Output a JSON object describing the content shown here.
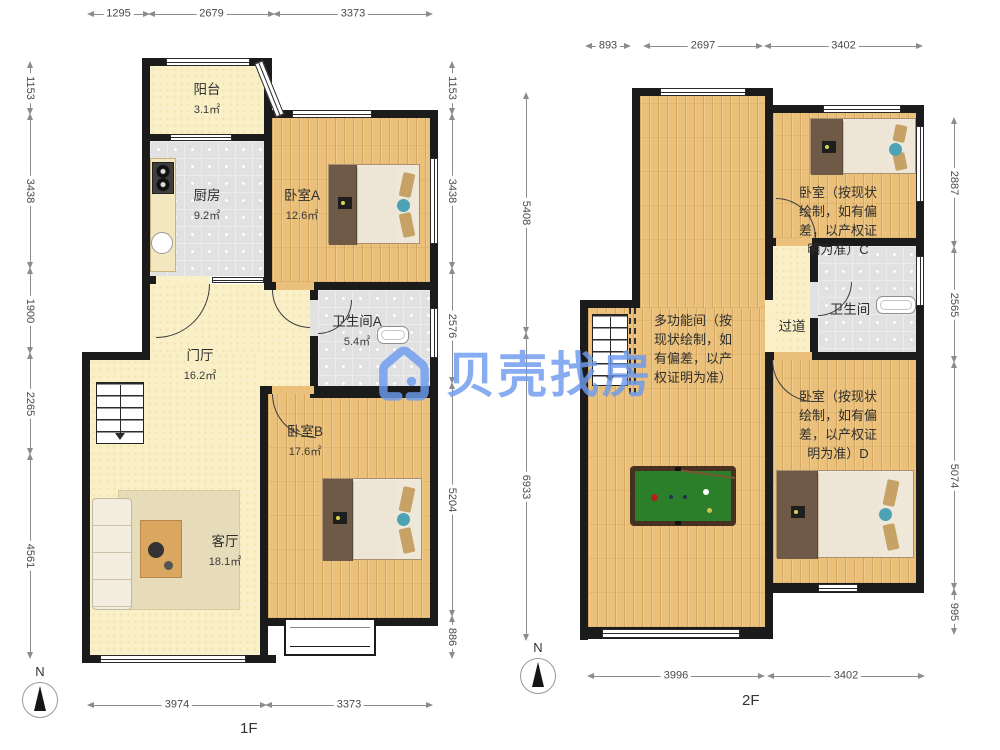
{
  "watermark": {
    "brand": "贝壳找房"
  },
  "floor1": {
    "label": "1F",
    "north": "N",
    "rooms": {
      "balcony": {
        "name": "阳台",
        "area": "3.1㎡"
      },
      "kitchen": {
        "name": "厨房",
        "area": "9.2㎡"
      },
      "bedroomA": {
        "name": "卧室A",
        "area": "12.6㎡"
      },
      "bathA": {
        "name": "卫生间A",
        "area": "5.4㎡"
      },
      "hall": {
        "name": "门厅",
        "area": "16.2㎡"
      },
      "bedroomB": {
        "name": "卧室B",
        "area": "17.6㎡"
      },
      "living": {
        "name": "客厅",
        "area": "18.1㎡"
      }
    },
    "dims": {
      "top": [
        "1295",
        "2679",
        "3373"
      ],
      "left": [
        "1153",
        "3438",
        "1900",
        "2265",
        "4561"
      ],
      "right": [
        "1153",
        "3438",
        "2576",
        "5204",
        "886"
      ],
      "bottom": [
        "3974",
        "3373"
      ]
    }
  },
  "floor2": {
    "label": "2F",
    "north": "N",
    "rooms": {
      "multi": {
        "name": "多功能间（按现状绘制，如有偏差，以产权证明为准）"
      },
      "corridor": {
        "name": "过道"
      },
      "bath": {
        "name": "卫生间"
      },
      "bedroomC": {
        "name": "卧室（按现状绘制，如有偏差，以产权证明为准）C"
      },
      "bedroomD": {
        "name": "卧室（按现状绘制，如有偏差，以产权证明为准）D"
      }
    },
    "dims": {
      "top": [
        "893",
        "2697",
        "3402"
      ],
      "left": [
        "5408",
        "6933"
      ],
      "right": [
        "2887",
        "2565",
        "5074",
        "995"
      ],
      "bottom": [
        "3996",
        "3402"
      ]
    }
  }
}
